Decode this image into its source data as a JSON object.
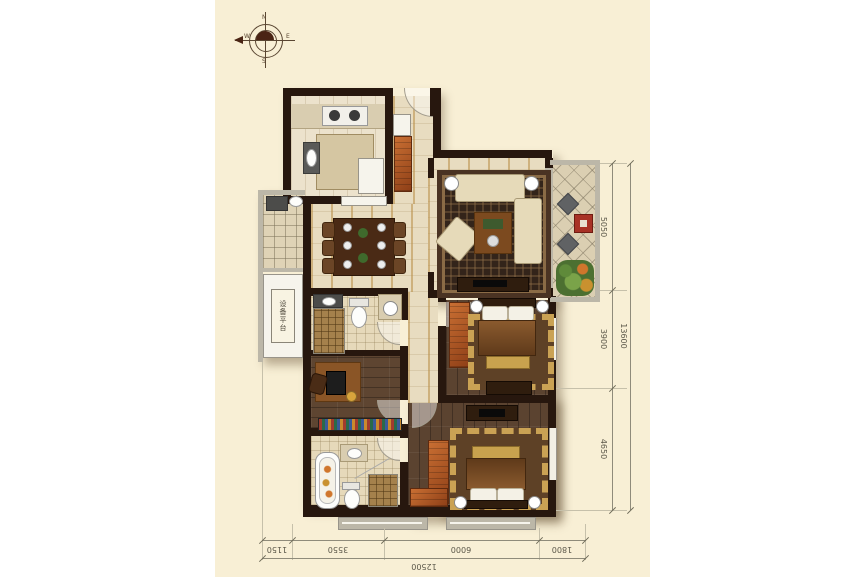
{
  "compass": {
    "n": "N",
    "e": "E",
    "s": "S",
    "w": "W"
  },
  "plan": {
    "equipment_platform_label": "设备平台"
  },
  "dimensions": {
    "right": {
      "segments": [
        "5050",
        "3900",
        "4650"
      ],
      "total": "13600"
    },
    "bottom": {
      "segments": [
        "1150",
        "3550",
        "6000",
        "1800"
      ],
      "total": "12500"
    }
  },
  "colors": {
    "canvas": "#ffffff",
    "panel": "#f8efd5",
    "wall": "#27170e",
    "floor_tile": "#e8dcc0",
    "wood": "#5b4330",
    "accent_orange": "#b45a26",
    "accent_red": "#a83226",
    "dimension_text": "#5c584a"
  }
}
